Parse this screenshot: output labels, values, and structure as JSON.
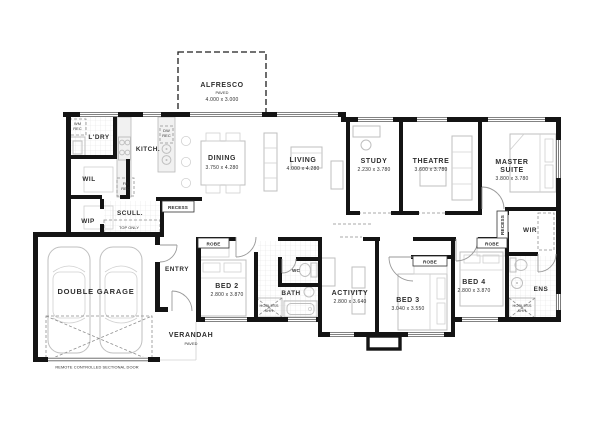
{
  "plan": {
    "rooms": {
      "alfresco": {
        "name": "ALFRESCO",
        "sub": "PAVED",
        "dims": "4.000 x 3.000"
      },
      "ldry": {
        "name": "L'DRY"
      },
      "kitch": {
        "name": "KITCH."
      },
      "wil": {
        "name": "WIL"
      },
      "wip": {
        "name": "WIP"
      },
      "scull": {
        "name": "SCULL.",
        "sub": "TOP ONLY"
      },
      "dining": {
        "name": "DINING",
        "dims": "3.750 x 4.280"
      },
      "living": {
        "name": "LIVING",
        "dims": "4.000 x 4.280"
      },
      "study": {
        "name": "STUDY",
        "dims": "2.230 x 3.780"
      },
      "theatre": {
        "name": "THEATRE",
        "dims": "3.600 x 3.780"
      },
      "master": {
        "name": "MASTER",
        "name2": "SUITE",
        "dims": "3.800 x 3.780"
      },
      "wir": {
        "name": "WIR"
      },
      "entry": {
        "name": "ENTRY"
      },
      "verandah": {
        "name": "VERANDAH",
        "sub": "PAVED"
      },
      "garage": {
        "name": "DOUBLE GARAGE",
        "sub": "REMOTE CONTROLLED SECTIONAL DOOR"
      },
      "bed2": {
        "name": "BED 2",
        "dims": "2.800 x 3.870"
      },
      "bed3": {
        "name": "BED 3",
        "dims": "3.040 x 3.550"
      },
      "bed4": {
        "name": "BED 4",
        "dims": "2.800 x 3.870"
      },
      "wc": {
        "name": "WC"
      },
      "bath": {
        "name": "BATH"
      },
      "activity": {
        "name": "ACTIVITY",
        "dims": "2.800 x 3.640"
      },
      "ens": {
        "name": "ENS"
      }
    },
    "fixtures": {
      "robe": "ROBE",
      "recess": "RECESS",
      "wm": {
        "l1": "WM",
        "l2": "REC"
      },
      "dw": {
        "l1": "DW",
        "l2": "REC"
      },
      "fr": {
        "l1": "FR",
        "l2": "REC"
      },
      "hobless": {
        "l1": "HOBLESS",
        "l2": "SHR"
      }
    },
    "colors": {
      "wall": "#141414",
      "furniture": "#bfbfbf",
      "text": "#2e2e2e",
      "background": "#ffffff"
    }
  }
}
